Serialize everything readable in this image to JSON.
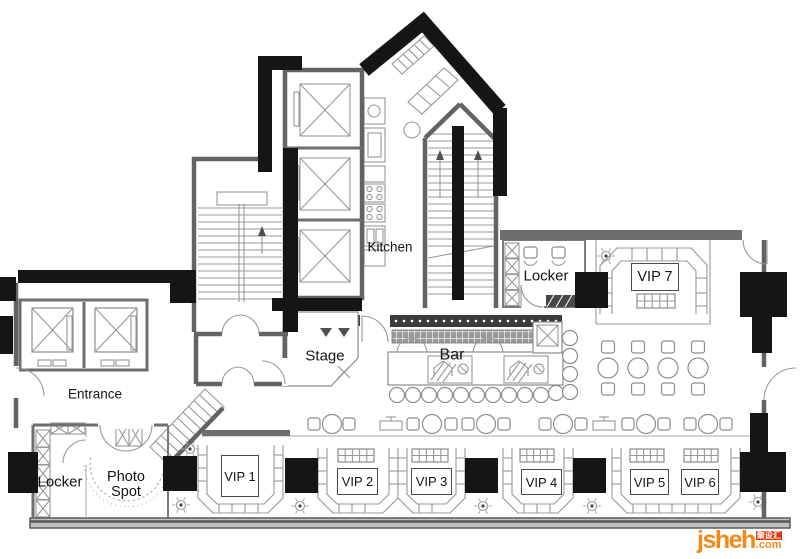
{
  "plan": {
    "rooms": {
      "kitchen": "Kitchen",
      "stage": "Stage",
      "bar": "Bar",
      "entrance": "Entrance",
      "locker_upper": "Locker",
      "locker_lower": "Locker",
      "photo_spot_line1": "Photo",
      "photo_spot_line2": "Spot",
      "vip1": "VIP 1",
      "vip2": "VIP 2",
      "vip3": "VIP 3",
      "vip4": "VIP 4",
      "vip5": "VIP 5",
      "vip6": "VIP 6",
      "vip7": "VIP 7"
    },
    "colors": {
      "wall_black": "#151515",
      "wall_gray": "#6e6e70",
      "thin_line": "#98989b",
      "led_strip": "#3c3c3c"
    }
  },
  "watermark": {
    "brand": "jsheh",
    "suffix": ".com",
    "badge": "聚设汇",
    "orange": "#f28a1a",
    "red": "#e6380e"
  }
}
